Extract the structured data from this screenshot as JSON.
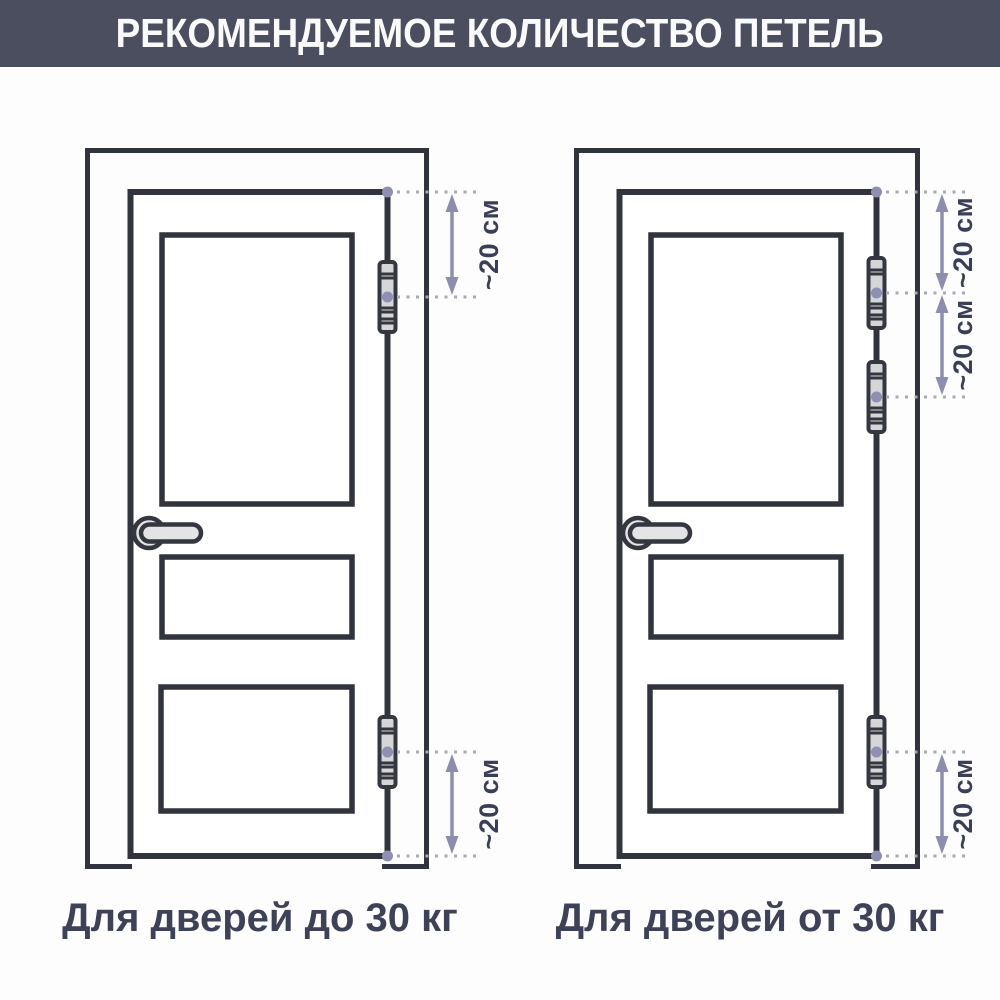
{
  "header": {
    "title": "РЕКОМЕНДУЕМОЕ КОЛИЧЕСТВО ПЕТЕЛЬ"
  },
  "diagrams": {
    "left": {
      "caption": "Для дверей до 30 кг",
      "hinge_count": 2,
      "dimensions": [
        {
          "label": "~20 см",
          "from": "верх двери",
          "to": "верхняя петля"
        },
        {
          "label": "~20 см",
          "from": "нижняя петля",
          "to": "низ двери"
        }
      ]
    },
    "right": {
      "caption": "Для дверей от 30 кг",
      "hinge_count": 3,
      "dimensions": [
        {
          "label": "~20 см",
          "from": "верх двери",
          "to": "первая петля"
        },
        {
          "label": "~20 см",
          "from": "первая петля",
          "to": "вторая петля"
        },
        {
          "label": "~20 см",
          "from": "нижняя петля",
          "to": "низ двери"
        }
      ]
    }
  },
  "colors": {
    "header_bg": "#4a4e5f",
    "header_text": "#fafafa",
    "outline": "#31343d",
    "hinge_fill": "#d6d6d9",
    "handle_fill": "#e4e4e7",
    "accent_arrow": "#8d8db0",
    "accent_dot": "#8f8fb3",
    "dotted_line": "#a9a9b3",
    "label_text": "#3a3f58",
    "caption_text": "#3d4258"
  }
}
